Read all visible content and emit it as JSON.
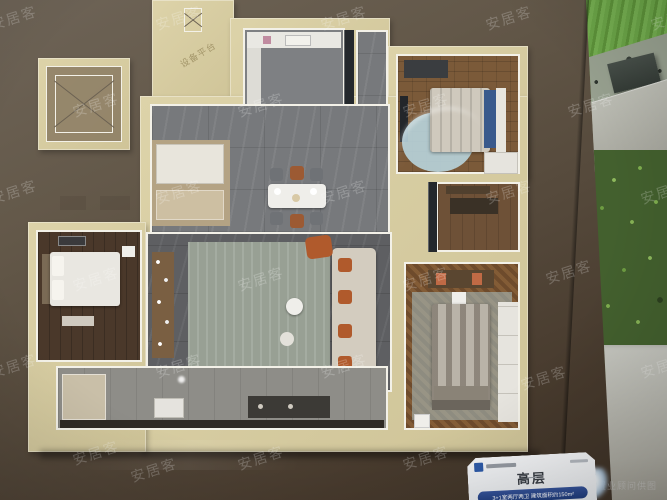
{
  "watermark": {
    "text": "安居客",
    "positions": [
      [
        -10,
        8
      ],
      [
        155,
        8
      ],
      [
        320,
        8
      ],
      [
        485,
        8
      ],
      [
        650,
        8
      ],
      [
        72,
        95
      ],
      [
        237,
        95
      ],
      [
        402,
        95
      ],
      [
        567,
        95
      ],
      [
        -10,
        182
      ],
      [
        155,
        182
      ],
      [
        320,
        182
      ],
      [
        485,
        182
      ],
      [
        640,
        182
      ],
      [
        72,
        269
      ],
      [
        237,
        269
      ],
      [
        402,
        269
      ],
      [
        545,
        262
      ],
      [
        -10,
        356
      ],
      [
        155,
        356
      ],
      [
        320,
        356
      ],
      [
        520,
        368
      ],
      [
        640,
        356
      ],
      [
        72,
        443
      ],
      [
        237,
        448
      ],
      [
        402,
        448
      ],
      [
        130,
        460
      ]
    ],
    "corner_text": "置业顾问供图"
  },
  "model": {
    "platform_label": "设备平台"
  },
  "sign": {
    "title": "高层",
    "spec": "3+1室两厅两卫 建筑面积约150m²"
  },
  "colors": {
    "table_brown": "#5a4e40",
    "wall_cream": "#d6cb9e",
    "wall_white": "#f3f1e8",
    "grass_green": "#6aa347",
    "plant_green": "#43602e",
    "sign_blue": "#2d5aa8",
    "accent_rust": "#b05a2c",
    "bedroom_blue": "#b8d4dd"
  }
}
